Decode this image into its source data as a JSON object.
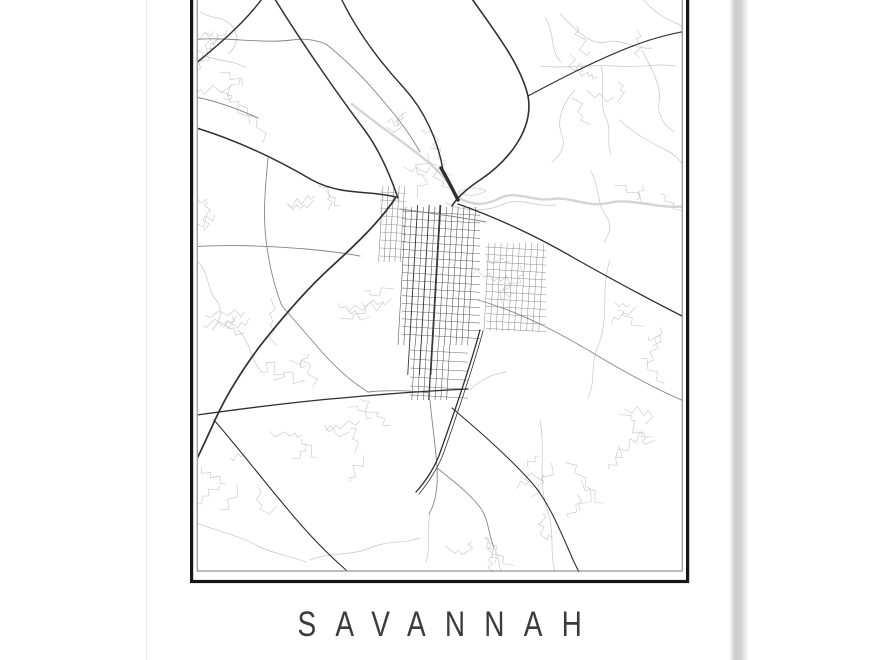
{
  "poster": {
    "title": "SAVANNAH",
    "title_color": "#3c3c3c",
    "background": "#ffffff",
    "frame": {
      "outer_color": "#151515",
      "inner_color": "#7a7a7a"
    },
    "edges": {
      "left_line_color": "#e8e8e8",
      "right_shadow_color": "#cbcbcb"
    }
  },
  "map": {
    "road_colors": {
      "primary": "#2f2f2f",
      "secondary": "#858585",
      "minor": "#c6c6c6",
      "water": "#d4d4d4"
    },
    "primary_paths": [
      {
        "d": "M264,-4 C246,22 215,48 190,68",
        "w": 1.4
      },
      {
        "d": "M273,-4 C300,40 336,92 366,132 C379,150 389,172 398,198",
        "w": 1.5
      },
      {
        "d": "M190,126 C238,140 278,160 312,180 C342,196 368,190 396,197",
        "w": 1.5
      },
      {
        "d": "M396,197 C380,222 352,248 330,268 C306,290 282,318 260,346 C242,370 226,396 215,420 C205,442 198,458 190,472",
        "w": 1.7
      },
      {
        "d": "M340,-4 C356,30 380,62 404,88 C424,110 438,140 443,170",
        "w": 1.4
      },
      {
        "d": "M441,168 C447,178 452,188 458,200",
        "w": 3.4
      },
      {
        "d": "M470,-4 C492,28 520,62 528,96 C534,128 510,160 480,180 C468,188 458,196 452,206",
        "w": 1.6
      },
      {
        "d": "M528,96 C558,80 600,58 638,44 C654,38 670,34 686,31",
        "w": 1.1
      },
      {
        "d": "M480,330 C472,360 458,402 441,450 C435,468 425,482 416,492",
        "w": 1.3
      },
      {
        "d": "M483,331 C475,361 461,403 444,452 C438,468 428,483 419,494",
        "w": 0.8
      },
      {
        "d": "M458,204 C498,218 540,238 574,258 C606,276 646,298 686,318",
        "w": 1.3
      },
      {
        "d": "M452,408 C478,430 508,456 533,484 C549,503 560,530 574,562 C576,566 578,570 580,574",
        "w": 1.1
      },
      {
        "d": "M190,416 C240,409 292,402 342,398 C384,394 424,391 468,389",
        "w": 1.3
      },
      {
        "d": "M214,420 C242,452 272,492 302,526 C316,542 330,556 346,570",
        "w": 1.1
      }
    ],
    "secondary_paths": [
      "M190,40 C226,36 258,44 292,40 C304,38 316,40 326,44",
      "M190,247 C228,244 266,246 306,249 C328,251 344,253 360,256",
      "M268,158 C265,190 263,214 266,240 C269,264 274,286 282,306",
      "M430,400 C432,424 436,448 437,468 C438,486 436,502 429,514",
      "M400,209 C430,213 460,217 486,222",
      "M478,300 C520,312 558,332 598,356 C628,374 658,390 686,402",
      "M326,44 C346,60 366,80 384,102 C398,118 410,134 420,152",
      "M190,96 C214,100 236,108 258,118",
      "M437,468 C452,480 468,492 479,506 C489,518 488,534 494,548",
      "M282,306 C296,322 310,338 322,352 C336,368 352,382 368,392",
      "M368,392 C388,390 408,390 430,393"
    ],
    "minor_paths": [
      "M560,14 C576,30 590,46 606,42 C622,38 636,50 652,48",
      "M540,66 C566,69 592,64 616,66 C642,68 658,63 676,66",
      "M601,66 C606,86 598,102 606,118 C612,130 606,142 611,154",
      "M575,90 C562,104 556,120 562,136 C566,146 560,156 552,162",
      "M642,50 C652,70 662,86 659,102 C657,114 664,126 674,132",
      "M545,18 C556,34 549,50 561,62",
      "M620,120 C634,134 650,142 666,150 C676,155 682,162 686,170",
      "M590,170 C600,186 596,202 606,216 C612,224 610,234 604,242",
      "M200,12 C214,20 224,16 232,26 C240,36 236,48 228,54",
      "M206,56 C220,62 234,60 246,68",
      "M196,260 C210,272 206,288 216,300 C224,310 220,322 212,330",
      "M238,330 C252,344 250,360 262,372",
      "M430,514 C426,532 431,546 426,562",
      "M494,548 C500,558 498,566 502,574",
      "M540,420 C546,452 537,482 548,512 C555,534 549,556 556,574",
      "M610,260 C600,290 610,318 598,346 C590,364 596,382 588,398",
      "M470,390 C480,380 492,374 506,372",
      "M310,560 C330,552 352,556 370,548 C388,540 404,544 420,538",
      "M190,520 C212,530 236,534 258,546 C274,554 290,556 306,562",
      "M640,-4 C650,8 662,18 678,24 C682,26 684,28 686,30"
    ],
    "water_paths": [
      {
        "d": "M352,104 C376,124 404,142 428,162 C440,172 450,184 456,196 C470,206 486,206 500,198 C516,190 534,202 552,199 C570,196 588,208 608,203 C632,197 658,210 686,206",
        "w": 2.4
      },
      {
        "d": "M446,203 C464,212 486,212 504,204 C520,197 538,208 556,205",
        "w": 1
      },
      {
        "d": "M458,192 C466,187 478,187 486,191 C478,196 466,197 458,192",
        "w": 0.8
      }
    ],
    "grids": [
      {
        "type": "v",
        "x0": 406,
        "y0": 207,
        "n": 13,
        "dx": 5.8,
        "len": 138,
        "tilt": -0.058,
        "color": "#4a4a4a",
        "w": 0.55
      },
      {
        "type": "v",
        "x0": 415,
        "y0": 345,
        "n": 7,
        "dx": 5.8,
        "len": 55,
        "tilt": -0.058,
        "color": "#555555",
        "w": 0.55
      },
      {
        "type": "h",
        "x0": 402,
        "y0": 211,
        "n": 17,
        "dy": 7.7,
        "len": 78,
        "tilt": 0.055,
        "color": "#5a5a5a",
        "w": 0.5
      },
      {
        "type": "h",
        "x0": 410,
        "y0": 350,
        "n": 6,
        "dy": 9,
        "len": 58,
        "tilt": 0.055,
        "color": "#666666",
        "w": 0.5
      },
      {
        "type": "v",
        "x0": 489,
        "y0": 243,
        "n": 10,
        "dx": 6.1,
        "len": 88,
        "tilt": -0.058,
        "color": "#8a8a8a",
        "w": 0.5
      },
      {
        "type": "h",
        "x0": 486,
        "y0": 247,
        "n": 12,
        "dy": 7.4,
        "len": 60,
        "tilt": 0.055,
        "color": "#8a8a8a",
        "w": 0.5
      },
      {
        "type": "v",
        "x0": 383,
        "y0": 186,
        "n": 5,
        "dx": 5.4,
        "len": 76,
        "tilt": -0.058,
        "color": "#777777",
        "w": 0.5
      },
      {
        "type": "h",
        "x0": 380,
        "y0": 192,
        "n": 9,
        "dy": 8,
        "len": 26,
        "tilt": 0.055,
        "color": "#888888",
        "w": 0.45
      },
      {
        "type": "v",
        "x0": 417.6,
        "y0": 205,
        "n": 3,
        "dx": 11.6,
        "len": 170,
        "tilt": -0.058,
        "color": "#3b3b3b",
        "w": 0.9
      },
      {
        "type": "v",
        "x0": 440,
        "y0": 205,
        "n": 1,
        "dx": 0,
        "len": 195,
        "tilt": -0.058,
        "color": "#333333",
        "w": 1.0
      }
    ],
    "clusters": [
      {
        "x": 213,
        "y": 30,
        "r": 20,
        "seed": 11,
        "n": 5
      },
      {
        "x": 235,
        "y": 95,
        "r": 25,
        "seed": 177,
        "n": 5
      },
      {
        "x": 322,
        "y": 198,
        "r": 15,
        "seed": 22,
        "n": 4
      },
      {
        "x": 428,
        "y": 160,
        "r": 16,
        "seed": 33,
        "n": 4
      },
      {
        "x": 336,
        "y": 424,
        "r": 36,
        "seed": 44,
        "n": 9
      },
      {
        "x": 252,
        "y": 300,
        "r": 24,
        "seed": 55,
        "n": 5
      },
      {
        "x": 602,
        "y": 62,
        "r": 36,
        "seed": 66,
        "n": 7
      },
      {
        "x": 641,
        "y": 332,
        "r": 28,
        "seed": 77,
        "n": 6
      },
      {
        "x": 556,
        "y": 482,
        "r": 32,
        "seed": 88,
        "n": 7
      },
      {
        "x": 232,
        "y": 470,
        "r": 26,
        "seed": 99,
        "n": 5
      },
      {
        "x": 472,
        "y": 532,
        "r": 18,
        "seed": 111,
        "n": 4
      },
      {
        "x": 382,
        "y": 302,
        "r": 22,
        "seed": 122,
        "n": 5
      },
      {
        "x": 505,
        "y": 262,
        "r": 16,
        "seed": 133,
        "n": 4
      },
      {
        "x": 660,
        "y": 185,
        "r": 20,
        "seed": 144,
        "n": 3
      },
      {
        "x": 410,
        "y": 120,
        "r": 14,
        "seed": 155,
        "n": 3
      },
      {
        "x": 300,
        "y": 370,
        "r": 18,
        "seed": 166,
        "n": 4
      },
      {
        "x": 205,
        "y": 205,
        "r": 14,
        "seed": 188,
        "n": 3
      },
      {
        "x": 620,
        "y": 430,
        "r": 24,
        "seed": 199,
        "n": 5
      }
    ]
  }
}
